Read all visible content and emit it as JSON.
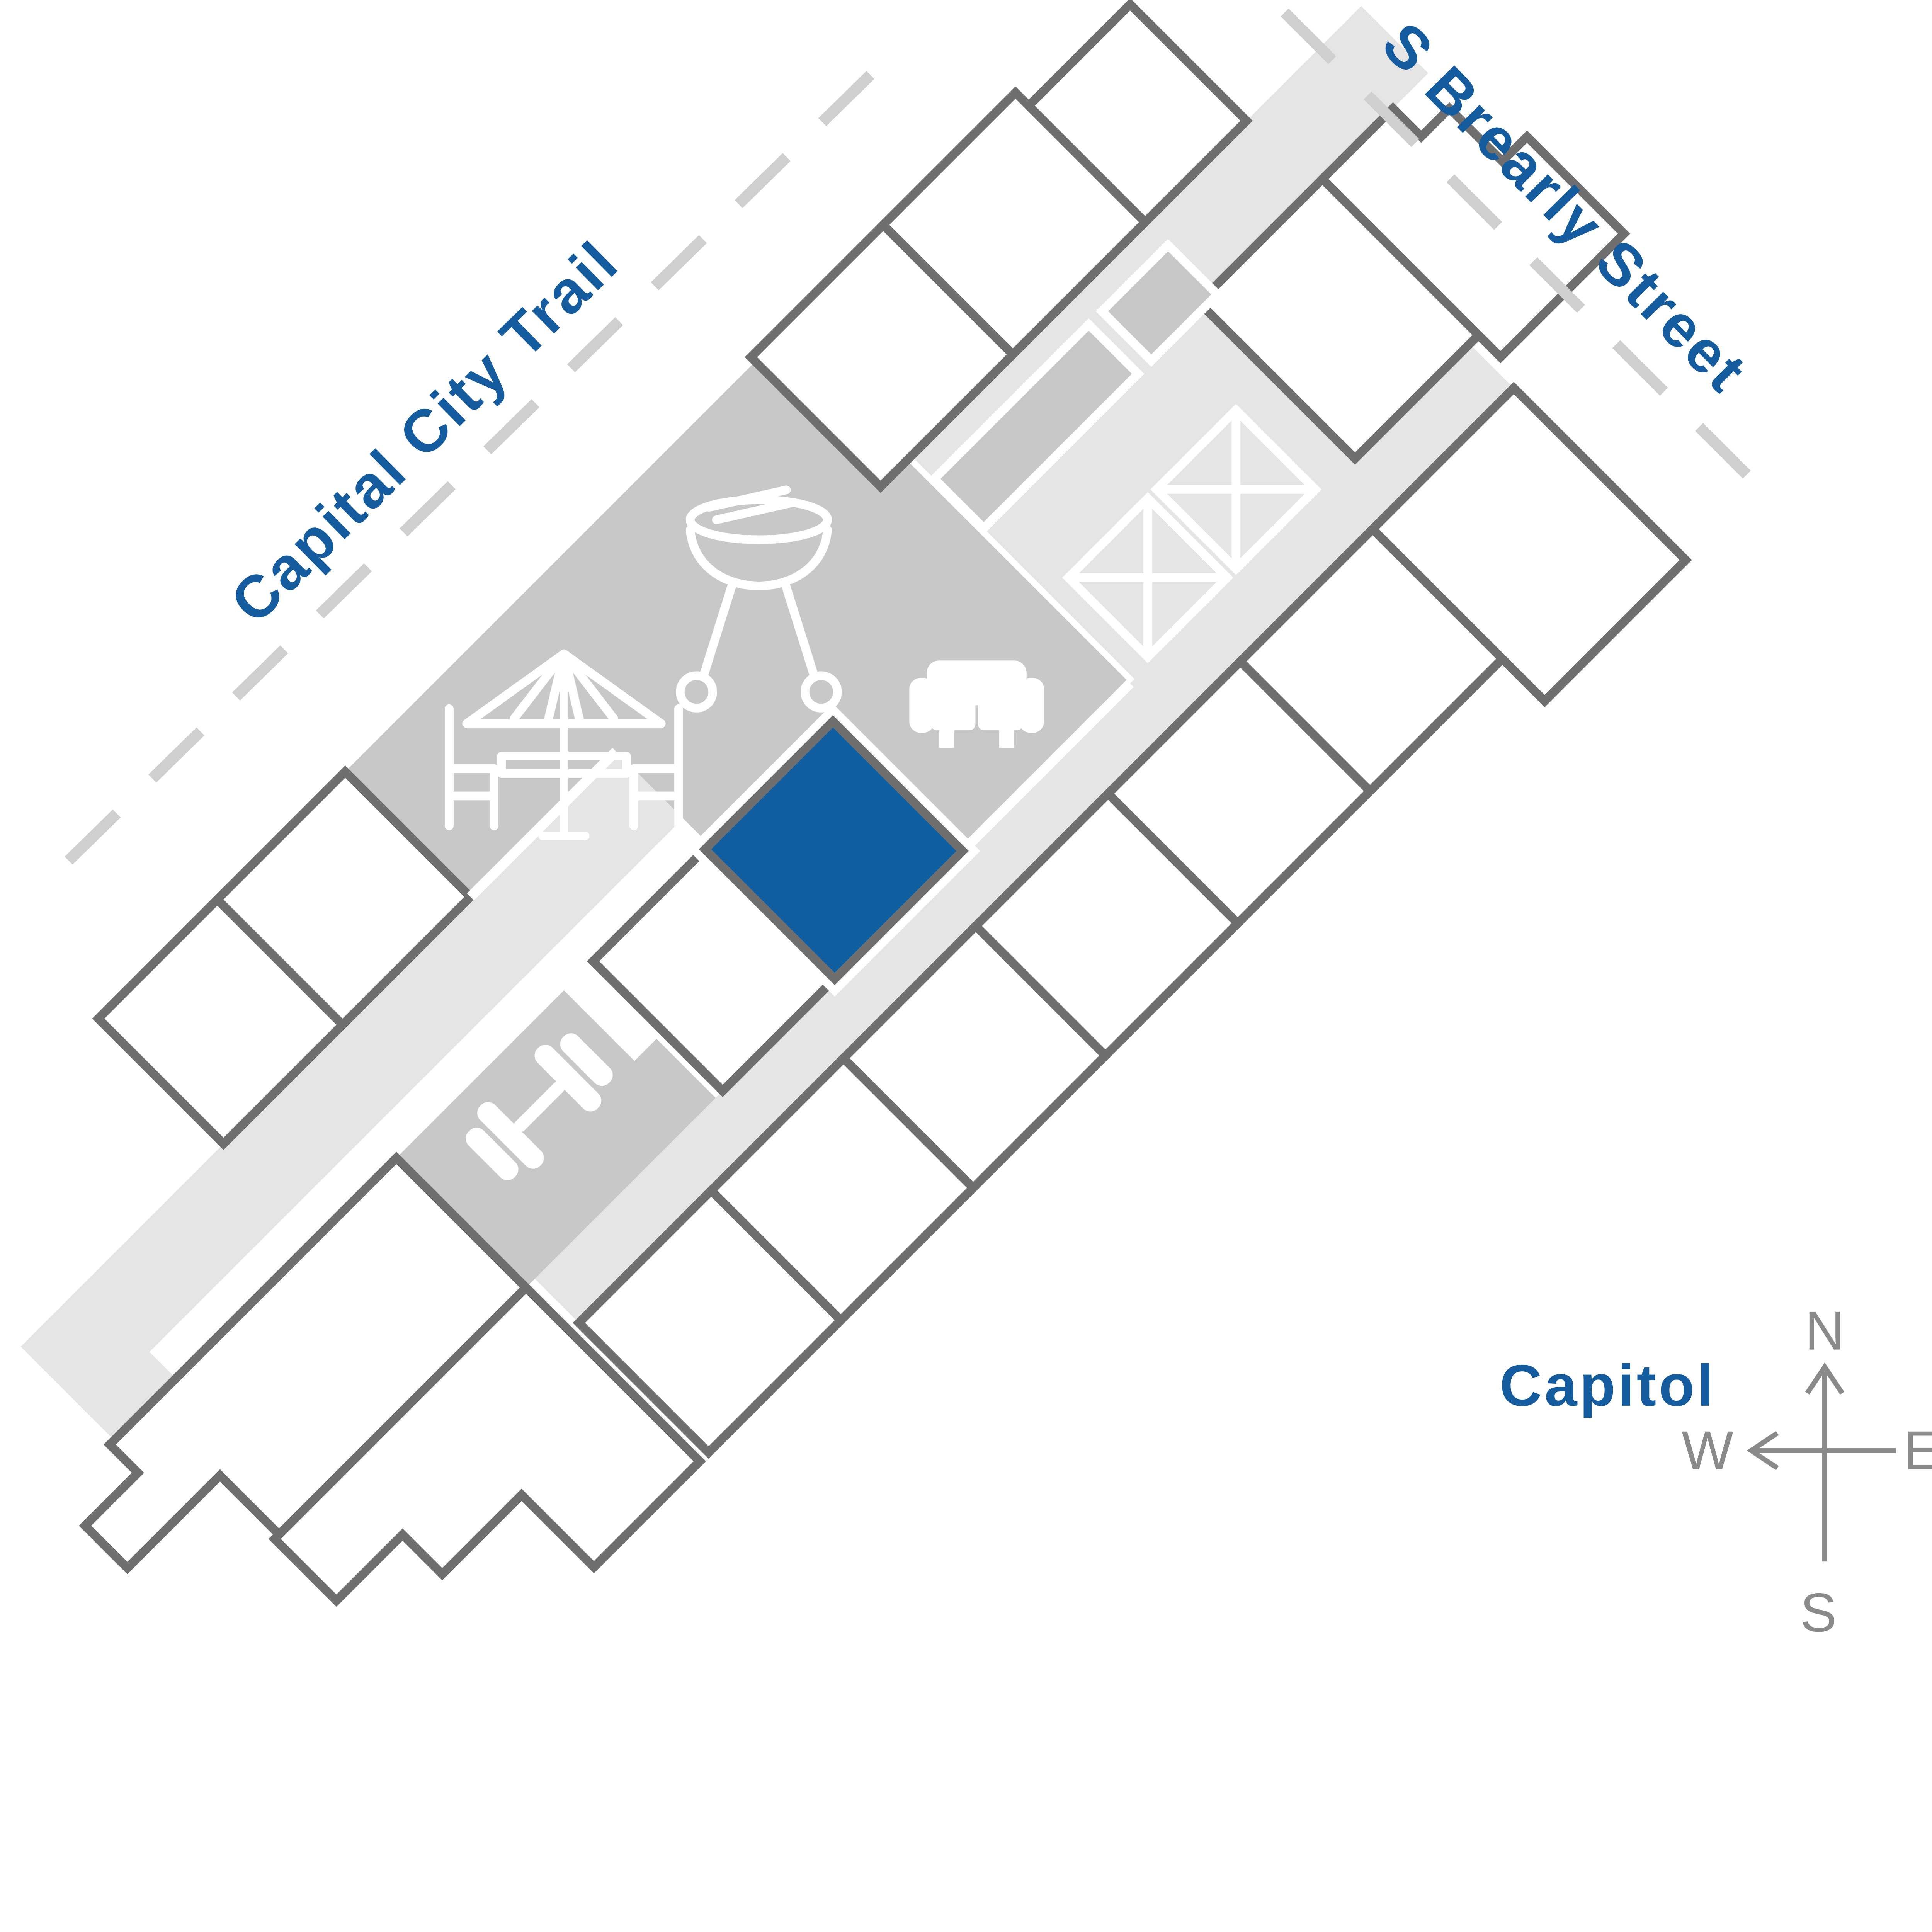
{
  "streets": {
    "trail_label": "Capital City Trail",
    "street_label": "S Brearly Street"
  },
  "landmarks": {
    "capitol_label": "Capitol"
  },
  "compass": {
    "north": "N",
    "east": "E",
    "south": "S",
    "west": "W"
  },
  "building": {
    "highlighted_unit": {
      "highlighted": true,
      "color": "#0F5FA1"
    },
    "amenity_icons": [
      "bbq-grill",
      "patio-umbrella-table",
      "sofa",
      "stairs",
      "stairs",
      "dumbbell"
    ],
    "stair_boxes": 2
  },
  "colors": {
    "highlight_blue": "#0F5FA1",
    "label_blue": "#155C9E",
    "unit_outline": "#6F6F6F",
    "amenity_gray": "#C8C8C8",
    "walkway_gray": "#E5E5E5",
    "dash_gray": "#CFCFCF",
    "compass_gray": "#8A8A8A"
  }
}
